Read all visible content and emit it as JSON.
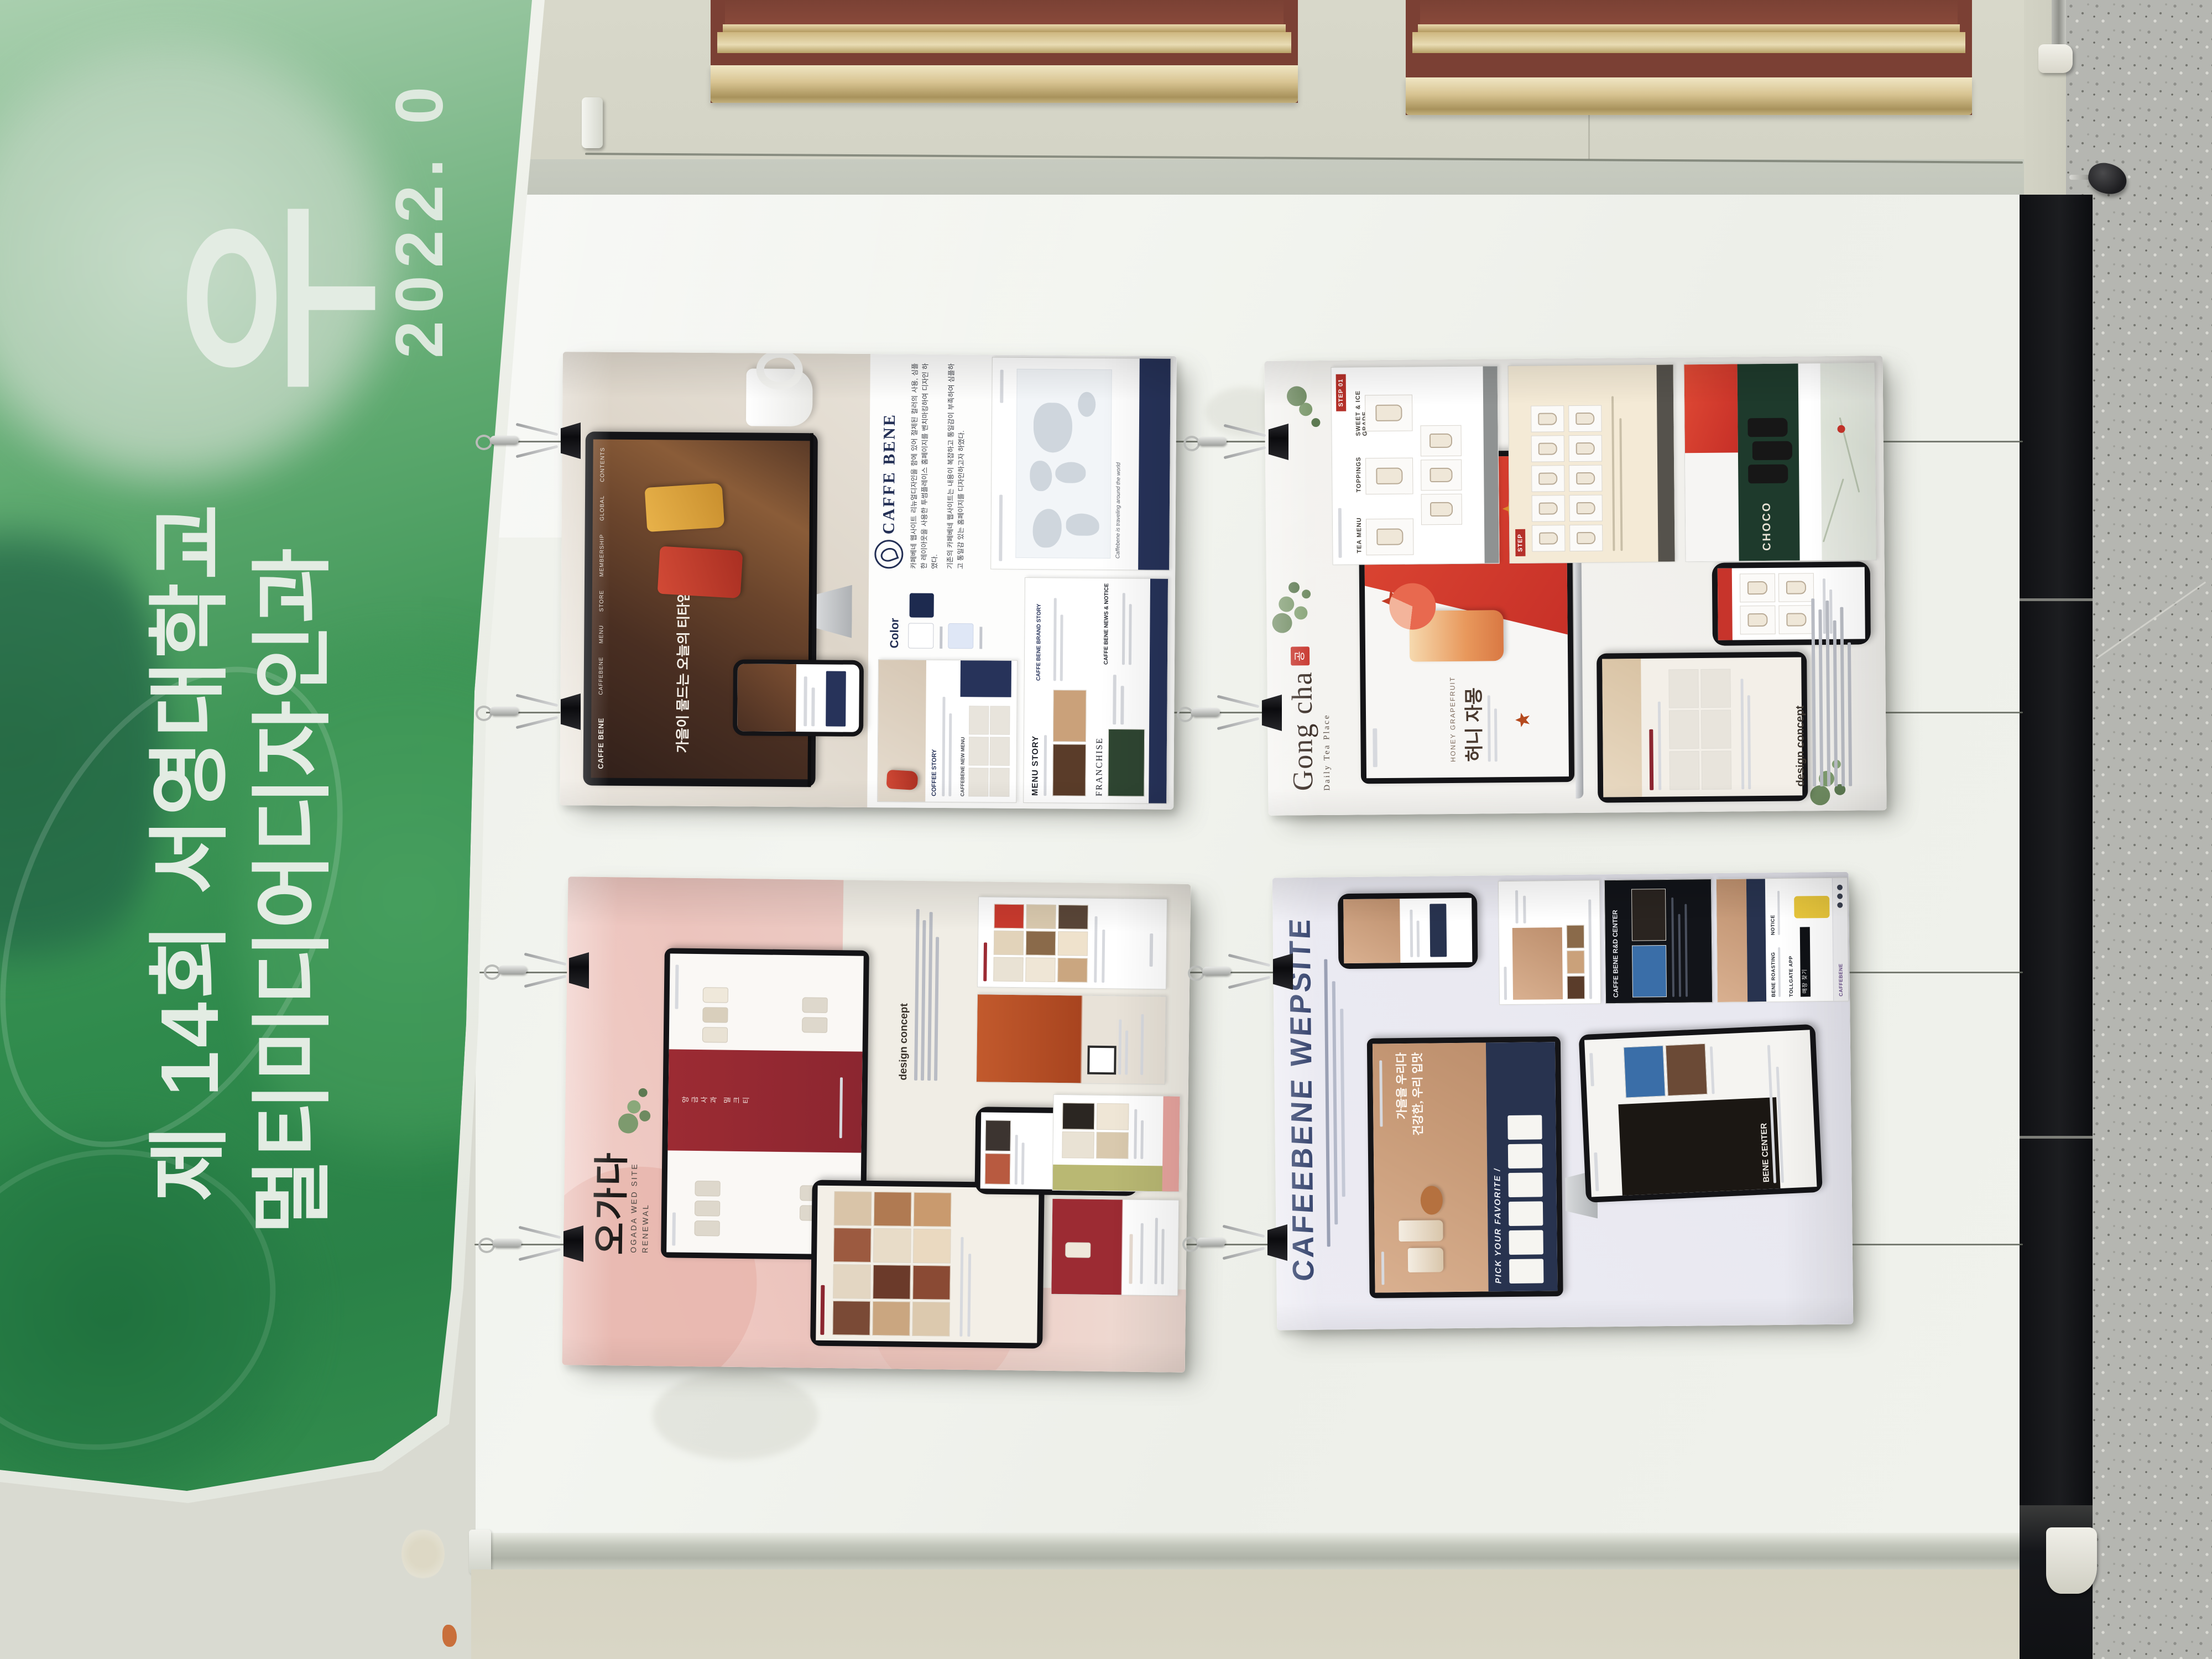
{
  "banner": {
    "big_char": "우",
    "date": "2022. 0",
    "event_line1": "제 14회 서영대학교",
    "event_line2": "멀티미디어디자인과",
    "colors": {
      "green_dark": "#2a8147",
      "green_mid": "#3f9657",
      "green_light": "#a9cfae",
      "text": "#e3ece3"
    }
  },
  "posters": {
    "caffebene": {
      "brand": "CAFFE BENE",
      "nav": [
        "CAFFEBENE",
        "MENU",
        "STORE",
        "MEMBERSHIP",
        "GLOBAL",
        "CONTENTS"
      ],
      "hero": "가을이 물드는 오늘의 티타임",
      "desc1": "카페베네 웹사이트 리뉴얼디자인을 함에 있어 절제된 컬러의 사용, 심플한 레이아웃을 사용한 투썸플레이스 홈페이지를 벤치마킹하여 디자인 하였다.",
      "desc2": "기존의 카페베네 웹사이트는 내용이 복잡하고 통일감이 부족하여 심플하고 통일감 있는 홈페이지를 디자인하고자 하였다.",
      "color_label": "Color",
      "coffee_story": "COFFEE STORY",
      "new_menu": "CAFFEBENE NEW MENU",
      "menu_story": "MENU STORY",
      "brand_story": "CAFFE BENE BRAND STORY",
      "franchise": "FRANCHISE",
      "news": "CAFFE BENE NEWS & NOTICE",
      "map_caption": "Caffebene is traveling around the world",
      "colors": {
        "navy": "#27335a",
        "red_pouch": "#c23b2e",
        "yellow_pouch": "#e0a73c"
      }
    },
    "gongcha": {
      "brand": "Gong cha",
      "mark": "공",
      "tagline": "Daily Tea Place",
      "hero_en": "HONEY GRAPEFRUIT",
      "hero_kr": "허니 자몽",
      "step1": "STEP 01",
      "step3": "STEP",
      "tea_menu": "TEA MENU",
      "toppings": "TOPPINGS",
      "sweet": "SWEET & ICE GRADE",
      "choco": "CHOCO",
      "concept": "design concept",
      "colors": {
        "red": "#c7342b",
        "dark_green": "#1e3a2c"
      }
    },
    "ogada": {
      "title": "오가다",
      "subtitle1": "OGADA WED SITE",
      "subtitle2": "RENEWAL",
      "concept": "design concept",
      "colors": {
        "pink": "#ecc4bd",
        "burgundy": "#8c2630"
      }
    },
    "cafeebene": {
      "title": "CAFEEBENE WEPSITE",
      "hero_line1": "가을을 우리다",
      "hero_line2": "건강한, 우리 입맛",
      "pick": "PICK YOUR FAVORITE /",
      "tablet_heading": "BENE CENTER",
      "rnd": "CAFFE BENE R&D CENTER",
      "roasting": "BENE ROASTING",
      "notice": "NOTICE",
      "tollgate": "TOLLGATE APP",
      "store_find": "매장 찾기",
      "brand": "CAFFEBENE",
      "colors": {
        "navy": "#28334f",
        "tan": "#c89b78"
      }
    }
  }
}
